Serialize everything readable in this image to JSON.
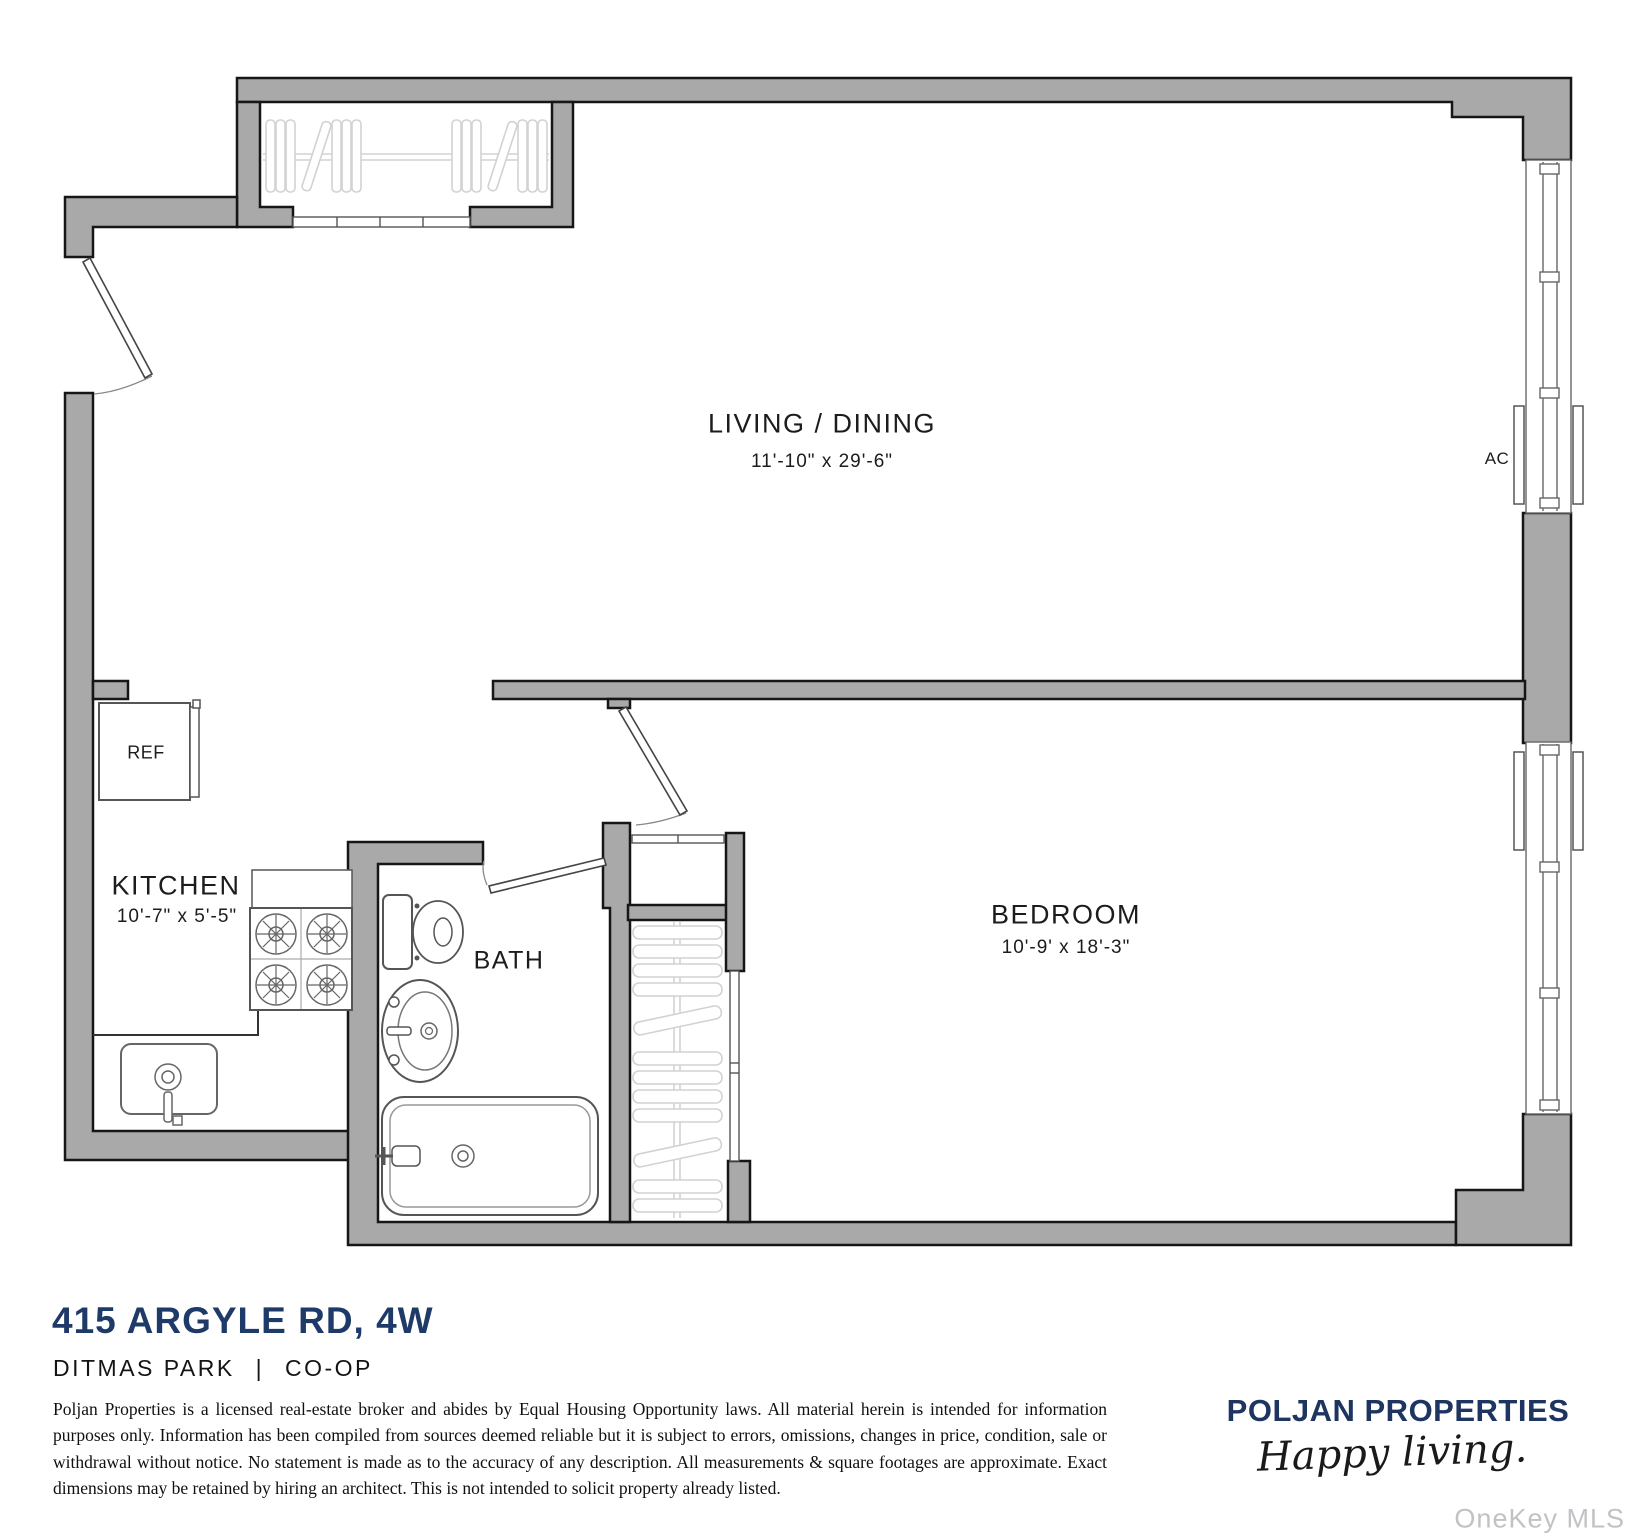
{
  "floorplan": {
    "rooms": {
      "living_dining": {
        "label": "LIVING / DINING",
        "dims": "11'-10\" x 29'-6\""
      },
      "kitchen": {
        "label": "KITCHEN",
        "dims": "10'-7\" x 5'-5\""
      },
      "bath": {
        "label": "BATH"
      },
      "bedroom": {
        "label": "BEDROOM",
        "dims": "10'-9' x 18'-3\""
      }
    },
    "appliances": {
      "refrigerator": "REF",
      "air_conditioner": "AC"
    },
    "icons": [
      "entry-door-icon",
      "bedroom-door-icon",
      "bath-door-icon",
      "window-icon",
      "ac-unit-icon",
      "closet-hangers-icon",
      "closet-shelves-icon",
      "stove-icon",
      "kitchen-sink-icon",
      "toilet-icon",
      "vanity-sink-icon",
      "bathtub-icon",
      "refrigerator-icon"
    ]
  },
  "listing": {
    "address": "415 ARGYLE RD, 4W",
    "neighborhood": "DITMAS PARK",
    "separator": "|",
    "type": "CO-OP"
  },
  "disclaimer": "Poljan Properties is a licensed real-estate broker and abides by Equal Housing Opportunity laws. All material herein is intended for information purposes only. Information has been compiled from sources deemed reliable but it is subject to errors, omissions, changes in price, condition, sale or withdrawal without notice. No statement is made as to the accuracy of any description. All measurements & square footages are approximate. Exact dimensions may be retained by hiring an architect. This is not intended to solicit property already listed.",
  "brand": {
    "name": "POLJAN PROPERTIES",
    "tagline": "Happy  living.",
    "watermark": "OneKey MLS"
  },
  "colors": {
    "wall": "#a9a9a9",
    "outline": "#161616",
    "navy": "#1e3a68",
    "brand_navy": "#1d3560",
    "watermark_gray": "#c2c2c6",
    "fixture_line": "#555555",
    "light_symbol": "#d2d2d2"
  }
}
